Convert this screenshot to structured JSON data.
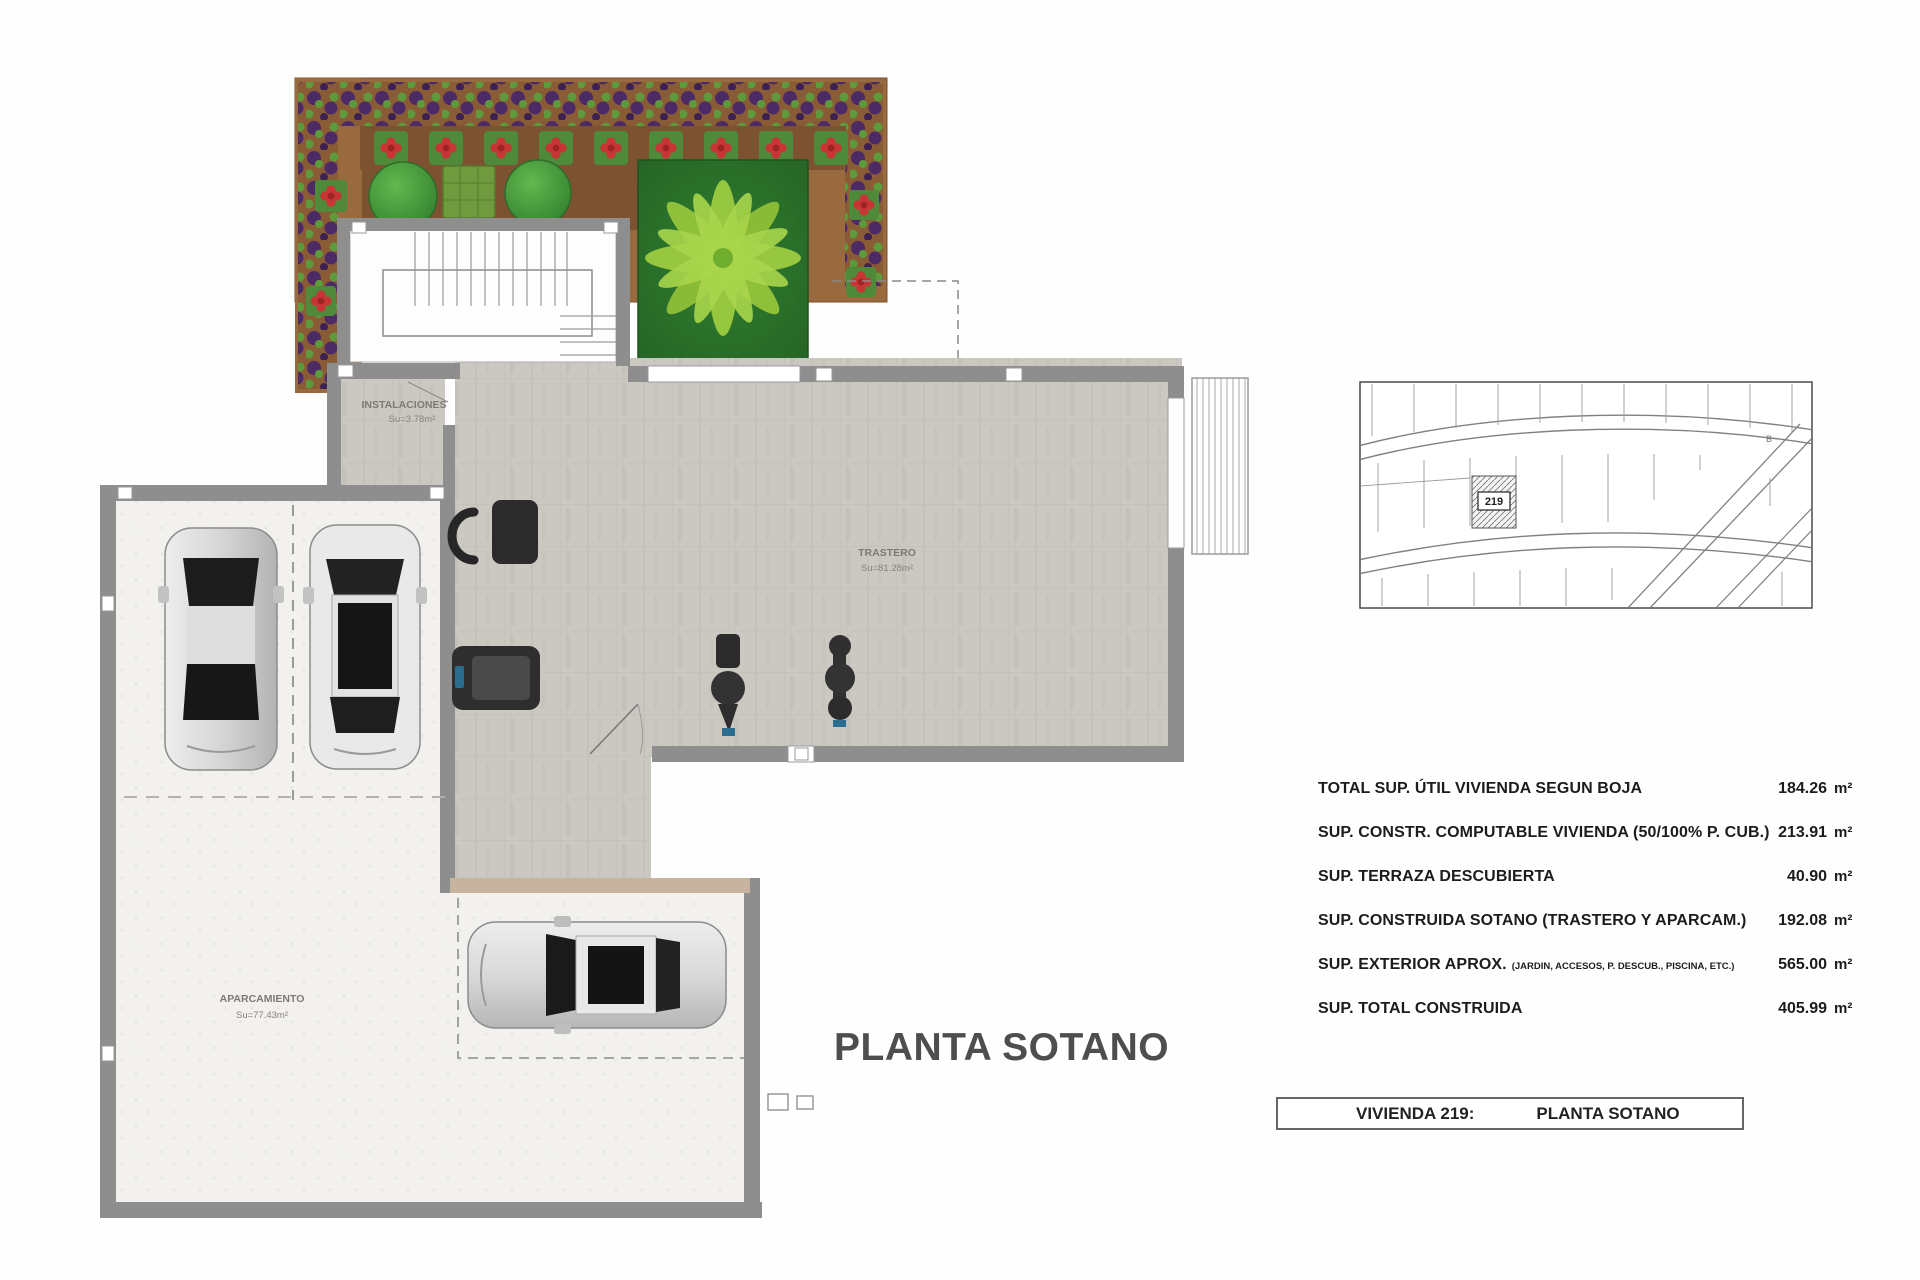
{
  "title": "PLANTA SOTANO",
  "plan": {
    "rooms": {
      "instalaciones": {
        "name": "INSTALACIONES",
        "area": "Su=3.78m²"
      },
      "trastero": {
        "name": "TRASTERO",
        "area": "Su=81.28m²"
      },
      "aparcamiento": {
        "name": "APARCAMIENTO",
        "area": "Su=77.43m²"
      }
    }
  },
  "site_map": {
    "plot_number": "219",
    "corner_label": "B"
  },
  "areas_table": {
    "rows": [
      {
        "label": "TOTAL SUP. ÚTIL VIVIENDA SEGUN BOJA",
        "note": "",
        "value": "184.26",
        "unit": "m²"
      },
      {
        "label": "SUP. CONSTR. COMPUTABLE VIVIENDA (50/100% P. CUB.)",
        "note": "",
        "value": "213.91",
        "unit": "m²"
      },
      {
        "label": "SUP. TERRAZA DESCUBIERTA",
        "note": "",
        "value": "40.90",
        "unit": "m²"
      },
      {
        "label": "SUP. CONSTRUIDA SOTANO (TRASTERO Y APARCAM.)",
        "note": "",
        "value": "192.08",
        "unit": "m²"
      },
      {
        "label": "SUP. EXTERIOR APROX.",
        "note": "(JARDIN, ACCESOS, P. DESCUB., PISCINA, ETC.)",
        "value": "565.00",
        "unit": "m²"
      },
      {
        "label": "SUP. TOTAL CONSTRUIDA",
        "note": "",
        "value": "405.99",
        "unit": "m²"
      }
    ]
  },
  "footer": {
    "house_label": "VIVIENDA 219:",
    "plan_label": "PLANTA SOTANO"
  },
  "colors": {
    "garden_soil": "#9a6a3f",
    "garden_soil_dark": "#7c5230",
    "plant_purple": "#4b2a66",
    "plant_green": "#5d9a3c",
    "flower_red": "#c93434",
    "bush_green": "#3fa33f",
    "palm_light": "#9ccb3f",
    "palm_dark": "#2f7e2f",
    "wall_gray": "#8e8e8e",
    "tile_gray": "#cbc7c1",
    "parking_floor": "#f2f1ee",
    "title_gray": "#4e4e4e"
  }
}
